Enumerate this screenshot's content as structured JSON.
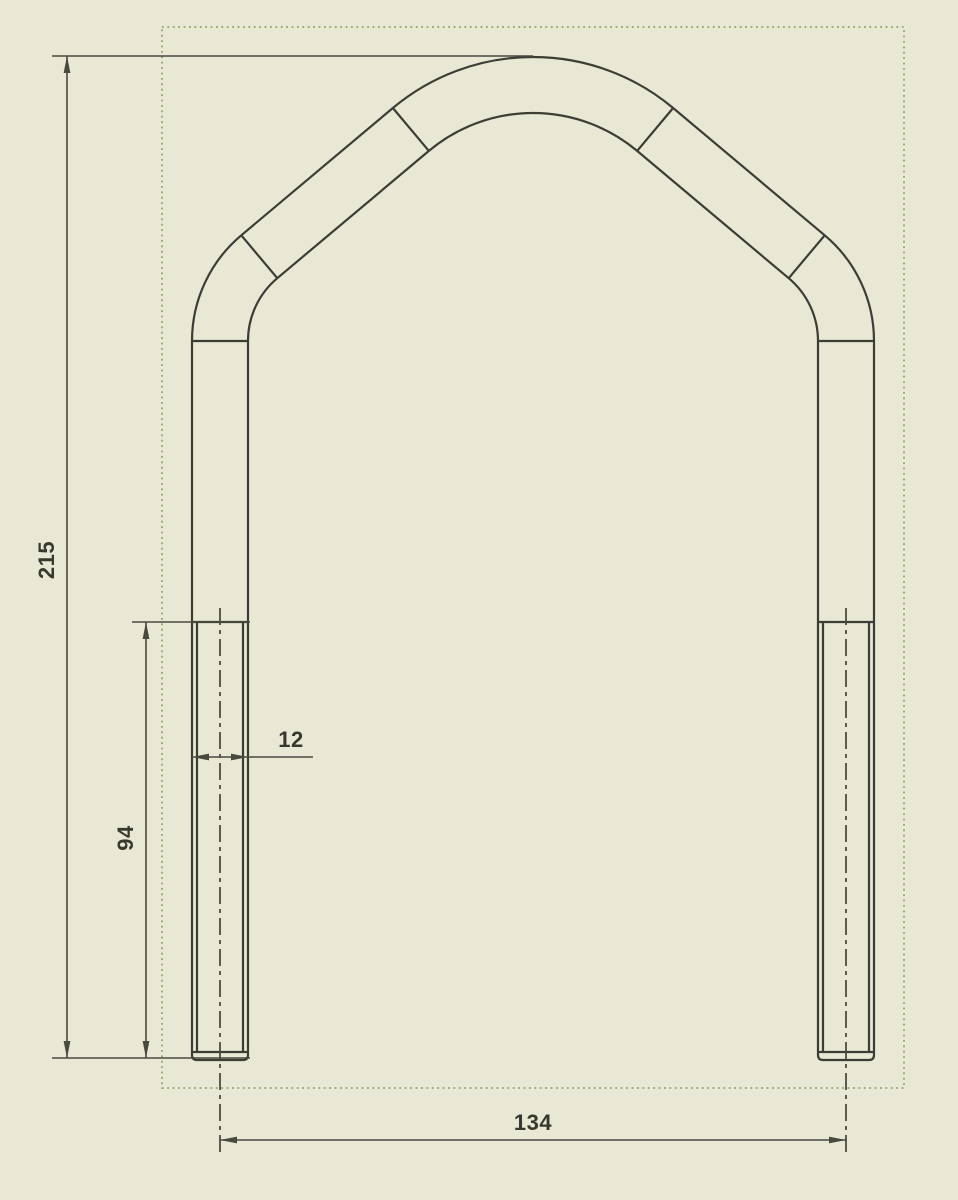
{
  "app": {
    "context": "CAD drawing viewport",
    "view": "U-bolt front view"
  },
  "canvas": {
    "width": 958,
    "height": 1200,
    "background": "#e9e8d5"
  },
  "sheet_boundary": {
    "x": 162,
    "y": 27,
    "width": 742,
    "height": 1061,
    "color": "#9daa76"
  },
  "styles": {
    "part_line_color": "#3e3d35",
    "dimension_line_color": "#4a493f",
    "centerline_color": "#45443a",
    "text_color": "#39382e"
  },
  "part": {
    "name": "u-bolt-with-peaked-arch",
    "leg_center_left_x": 220,
    "leg_center_right_x": 846,
    "half_width": 28,
    "leg_bottom_y": 1052,
    "leg_top_y": 341,
    "bend_radius": 110,
    "peak_radius": 190,
    "peak_center_x": 533,
    "peak_center_y": 275,
    "tangent_angle_deg": 130,
    "thread_top_y": 622,
    "thread_half_width": 23,
    "cap_bottom_y": 1060,
    "cap_corner_radius": 5,
    "centerline_top_y": 608,
    "centerline_bottom_y": 1157
  },
  "dimensions": {
    "overall_height": {
      "label": "215",
      "rotated": true,
      "text_x": 47,
      "text_y": 560,
      "line_x": 67,
      "y1": 56,
      "y2": 1058,
      "ext_top_x1": 52,
      "ext_top_x2": 533,
      "ext_bot_x1": 52,
      "ext_bot_x2": 250
    },
    "thread_length": {
      "label": "94",
      "rotated": true,
      "text_x": 126,
      "text_y": 838,
      "line_x": 146,
      "y1": 622,
      "y2": 1058,
      "ext_top_x1": 132,
      "ext_top_x2": 250
    },
    "rod_diameter": {
      "label": "12",
      "rotated": false,
      "text_x": 291,
      "text_y": 740,
      "line_y": 757,
      "x1": 192,
      "x2": 248,
      "tail_x": 313
    },
    "leg_spacing": {
      "label": "134",
      "rotated": false,
      "text_x": 533,
      "text_y": 1123,
      "line_y": 1140,
      "x1": 220,
      "x2": 846
    }
  }
}
